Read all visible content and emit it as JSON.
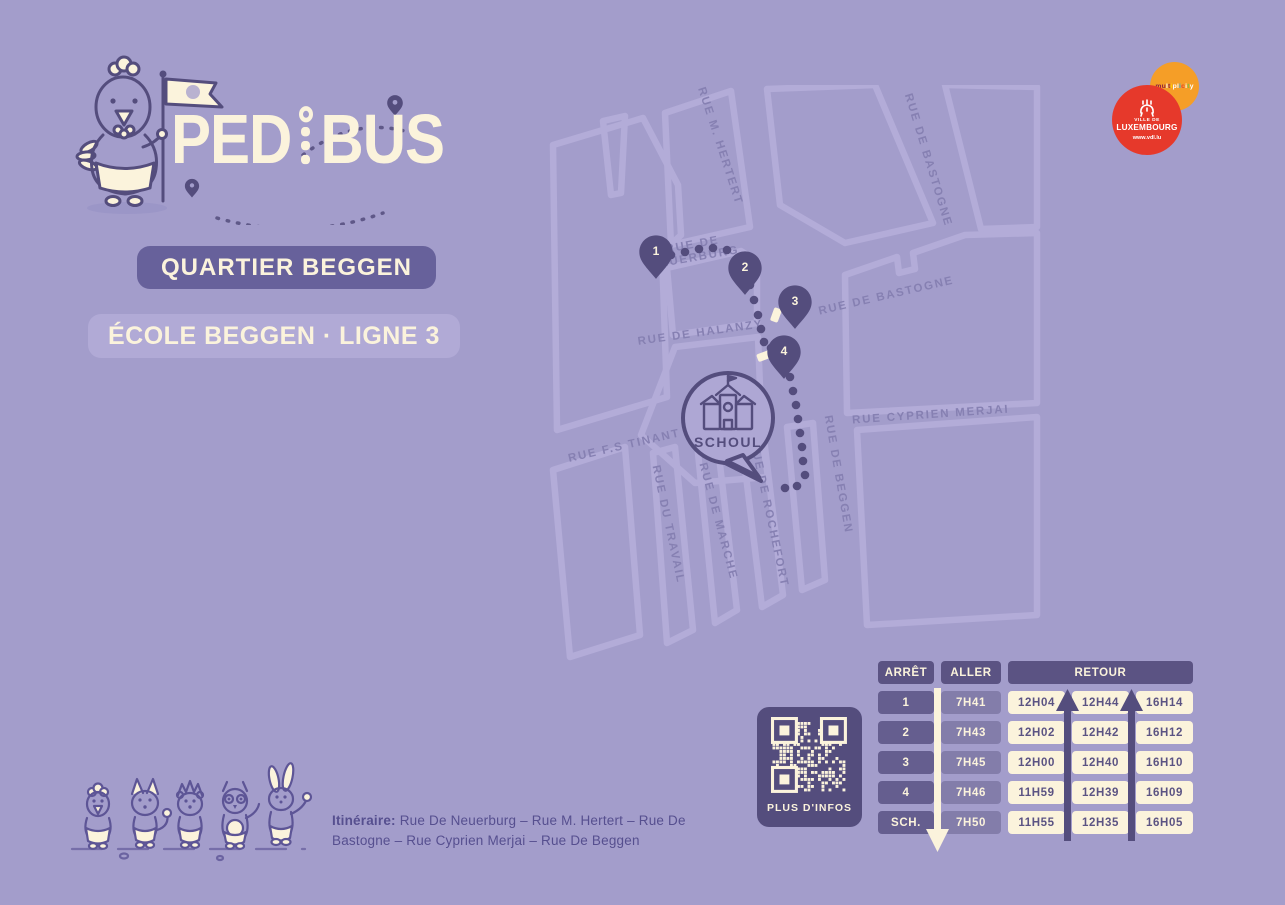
{
  "colors": {
    "background": "#a39dcb",
    "dark_purple": "#544d7d",
    "badge_purple": "#67619b",
    "light_purple": "#b1aad6",
    "cream": "#fbf3dc",
    "street_line": "#b3acd8",
    "street_label": "#8680b2",
    "orange": "#f59e27",
    "red": "#e6392b",
    "text_purple": "#564f8f"
  },
  "logo": {
    "name": "PEDIBUS",
    "part1": "PED",
    "part2": "BUS"
  },
  "partner_logos": {
    "multiplicity": {
      "text": "multiplicity",
      "letter_colors": [
        "#8e2043",
        "#8e2043",
        "#ffffff",
        "#8e2043",
        "#ffd200",
        "#ffffff",
        "#ffffff",
        "#2bb3e6",
        "#e8432d",
        "#ffffff",
        "#79c143",
        "#ffffff"
      ]
    },
    "vdl": {
      "line1": "VILLE DE",
      "line2": "LUXEMBOURG",
      "url": "www.vdl.lu"
    }
  },
  "badges": {
    "quartier": "QUARTIER BEGGEN",
    "ligne": "ÉCOLE BEGGEN · LIGNE 3"
  },
  "map": {
    "school_label": "SCHOUL",
    "streets": [
      {
        "lines": [
          "RUE M. HERTERT"
        ],
        "x": 172,
        "y": 62,
        "rotate": 72
      },
      {
        "lines": [
          "RUE DE BASTOGNE"
        ],
        "x": 380,
        "y": 76,
        "rotate": 73
      },
      {
        "lines": [
          "RUE DE",
          "NEUERBURG"
        ],
        "x": 148,
        "y": 163,
        "rotate": -10
      },
      {
        "lines": [
          "RUE DE BASTOGNE"
        ],
        "x": 342,
        "y": 214,
        "rotate": -13
      },
      {
        "lines": [
          "RUE DE HALANZY"
        ],
        "x": 156,
        "y": 251,
        "rotate": -8
      },
      {
        "lines": [
          "RUE CYPRIEN MERJAI"
        ],
        "x": 386,
        "y": 333,
        "rotate": -4
      },
      {
        "lines": [
          "RUE F.S TINANT"
        ],
        "x": 80,
        "y": 364,
        "rotate": -13
      },
      {
        "lines": [
          "RUE DU TRAVAIL"
        ],
        "x": 120,
        "y": 440,
        "rotate": 78
      },
      {
        "lines": [
          "RUE DE MARCHE"
        ],
        "x": 170,
        "y": 437,
        "rotate": 75
      },
      {
        "lines": [
          "RUE DE ROCHEFORT"
        ],
        "x": 221,
        "y": 430,
        "rotate": 78
      },
      {
        "lines": [
          "RUE DE BEGGEN"
        ],
        "x": 290,
        "y": 390,
        "rotate": 80
      }
    ],
    "stops": [
      {
        "number": "1",
        "x": 111,
        "y": 167
      },
      {
        "number": "2",
        "x": 200,
        "y": 183
      },
      {
        "number": "3",
        "x": 250,
        "y": 217
      },
      {
        "number": "4",
        "x": 239,
        "y": 267
      }
    ],
    "route_dots": [
      [
        126,
        170
      ],
      [
        140,
        167
      ],
      [
        154,
        164
      ],
      [
        168,
        163
      ],
      [
        182,
        165
      ],
      [
        205,
        200
      ],
      [
        209,
        215
      ],
      [
        213,
        230
      ],
      [
        216,
        244
      ],
      [
        219,
        257
      ],
      [
        226,
        263
      ],
      [
        245,
        292
      ],
      [
        248,
        306
      ],
      [
        251,
        320
      ],
      [
        253,
        334
      ],
      [
        255,
        348
      ],
      [
        257,
        362
      ],
      [
        258,
        376
      ],
      [
        260,
        390
      ],
      [
        252,
        401
      ],
      [
        240,
        403
      ]
    ],
    "crosswalks": [
      {
        "x": 231,
        "y": 230,
        "rotate": 20,
        "w": 8,
        "h": 14
      },
      {
        "x": 219,
        "y": 271,
        "rotate": -20,
        "w": 14,
        "h": 8
      }
    ]
  },
  "timetable": {
    "headers": {
      "stop": "ARRÊT",
      "outbound": "ALLER",
      "return": "RETOUR"
    },
    "rows": [
      {
        "stop": "1",
        "aller": "7H41",
        "retour": [
          "12H04",
          "12H44",
          "16H14"
        ]
      },
      {
        "stop": "2",
        "aller": "7H43",
        "retour": [
          "12H02",
          "12H42",
          "16H12"
        ]
      },
      {
        "stop": "3",
        "aller": "7H45",
        "retour": [
          "12H00",
          "12H40",
          "16H10"
        ]
      },
      {
        "stop": "4",
        "aller": "7H46",
        "retour": [
          "11H59",
          "12H39",
          "16H09"
        ]
      },
      {
        "stop": "SCH.",
        "aller": "7H50",
        "retour": [
          "11H55",
          "12H35",
          "16H05"
        ]
      }
    ]
  },
  "qr": {
    "label": "PLUS D'INFOS"
  },
  "itinerary": {
    "label": "Itinéraire:",
    "route": "Rue De Neuerburg – Rue M. Hertert – Rue De Bastogne – Rue Cyprien Merjai – Rue De Beggen"
  }
}
